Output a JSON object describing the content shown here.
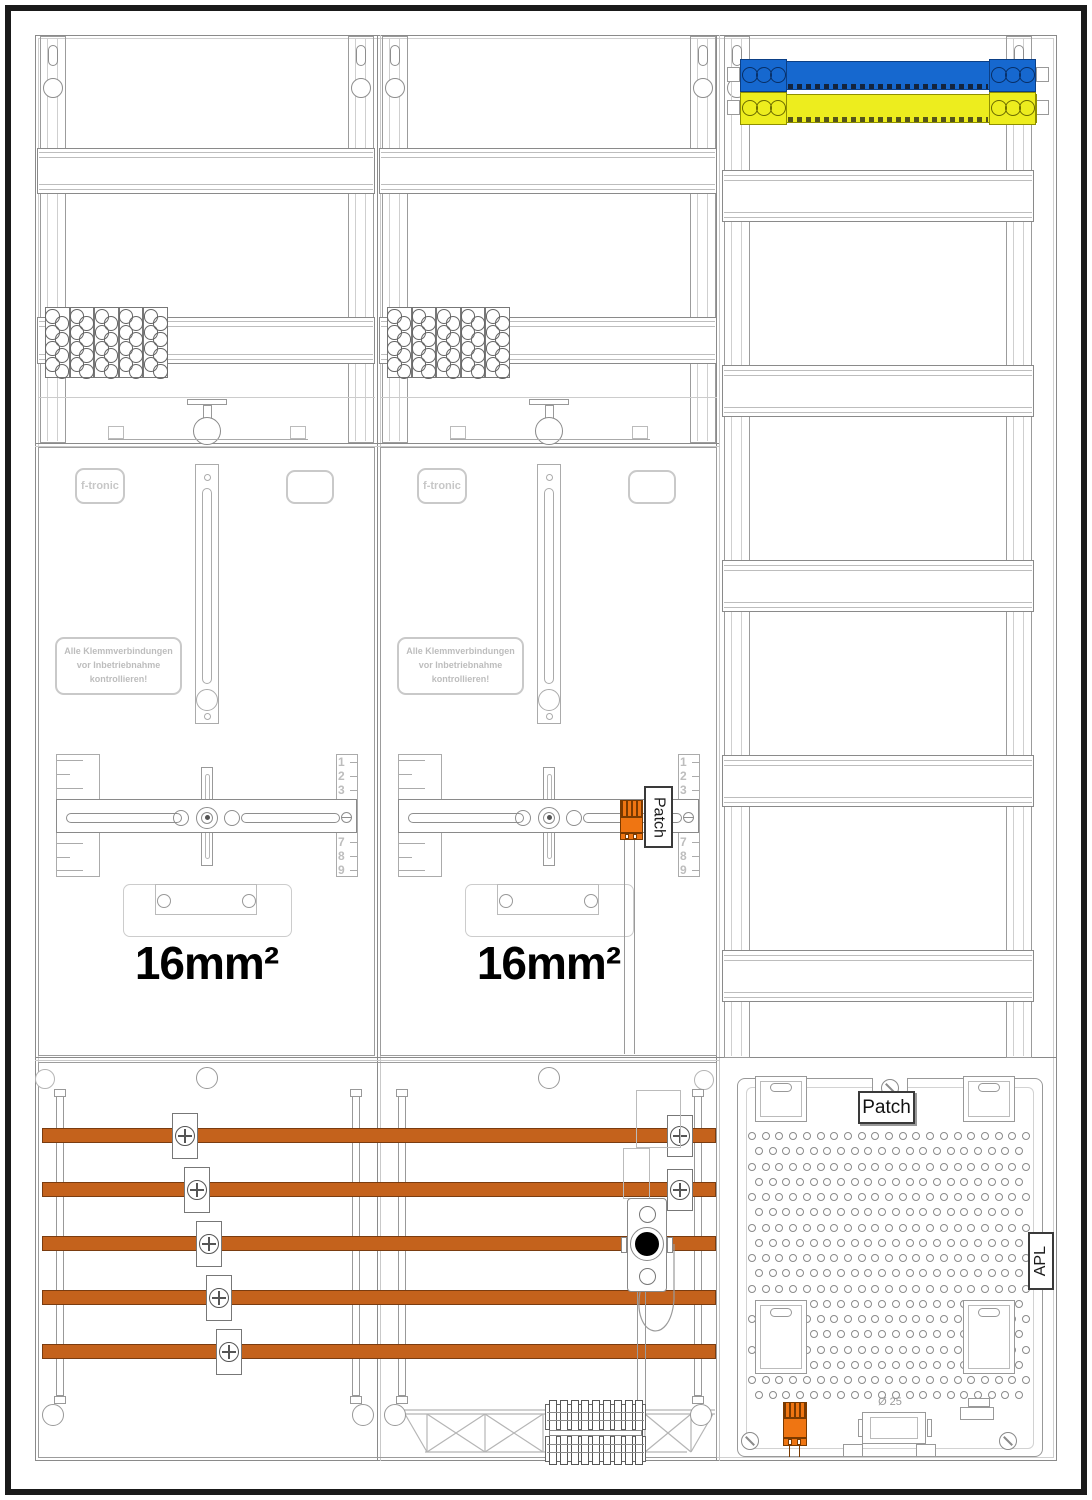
{
  "labels": {
    "brand": "f-tronic",
    "warning_lines": [
      "Alle Klemmverbindungen",
      "vor Inbetriebnahme",
      "kontrollieren!"
    ],
    "wire_gauge": "16mm²",
    "patch": "Patch",
    "apl": "APL",
    "diameter": "Ø 25",
    "ruler_top": [
      "1",
      "2",
      "3"
    ],
    "ruler_bottom": [
      "7",
      "8",
      "9"
    ]
  },
  "colors": {
    "busbar_phase_orange": "#c4621c",
    "component_orange": "#ef7512",
    "busbar_neutral_blue": "#1668cf",
    "busbar_earth_yellow": "#eded1e",
    "frame_black": "#1a1a1a",
    "line_gray": "#999999"
  }
}
